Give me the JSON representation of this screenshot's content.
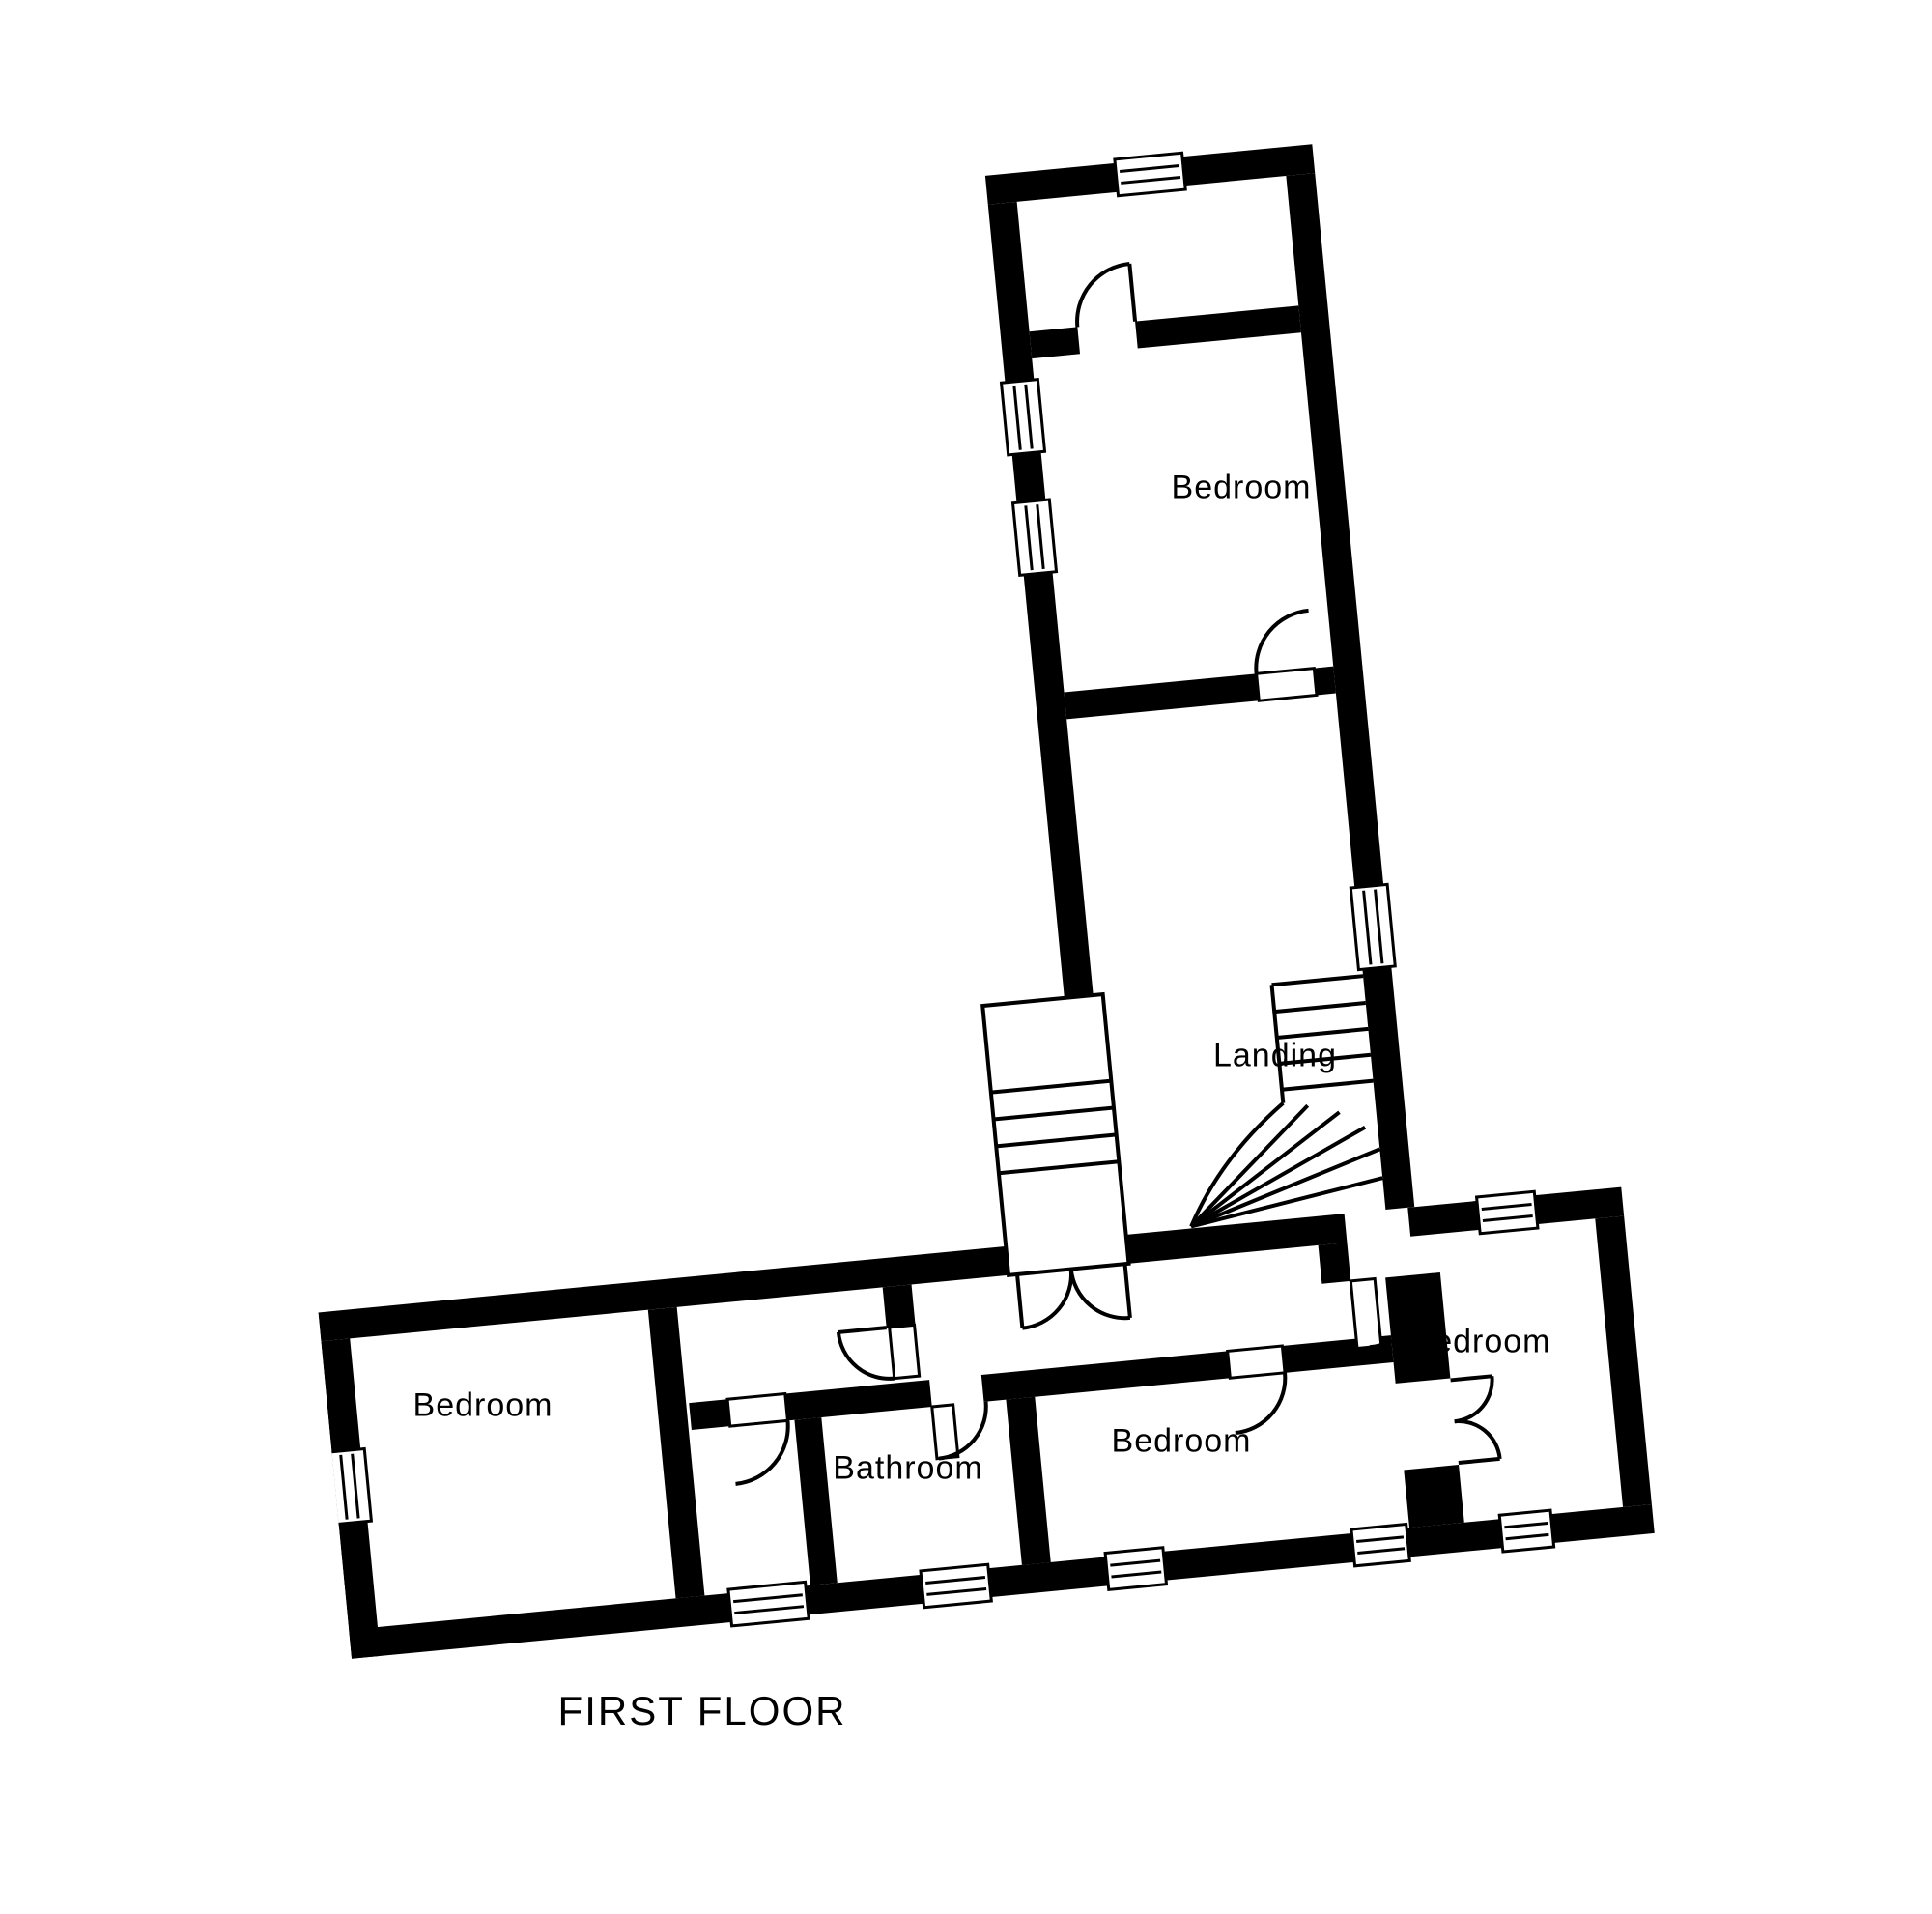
{
  "page": {
    "background_color": "#ffffff",
    "ink_color": "#000000"
  },
  "floor_plan": {
    "title": "FIRST FLOOR",
    "rooms": [
      {
        "id": "bedroom-top",
        "label": "Bedroom"
      },
      {
        "id": "landing",
        "label": "Landing"
      },
      {
        "id": "bedroom-left",
        "label": "Bedroom"
      },
      {
        "id": "bathroom",
        "label": "Bathroom"
      },
      {
        "id": "bedroom-middle",
        "label": "Bedroom"
      },
      {
        "id": "bedroom-right",
        "label": "Bedroom"
      }
    ]
  }
}
